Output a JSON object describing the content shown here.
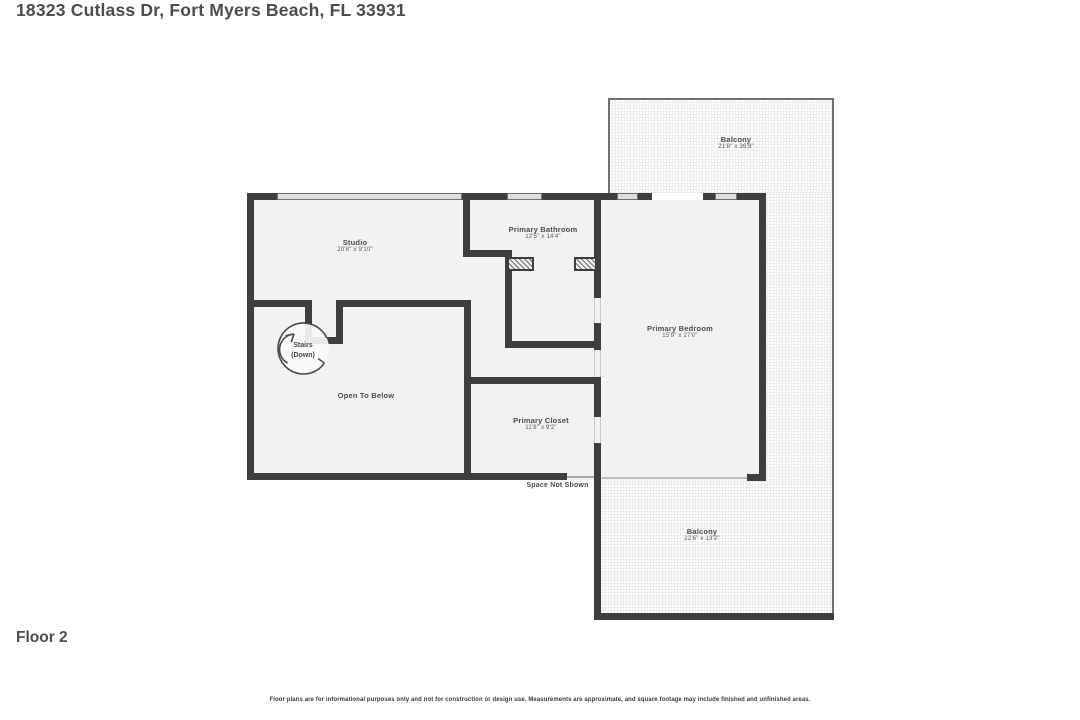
{
  "header": {
    "address": "18323 Cutlass Dr, Fort Myers Beach, FL 33931"
  },
  "footer": {
    "floor_label": "Floor 2",
    "disclaimer": "Floor plans are for informational purposes only and not for construction or design use. Measurements are approximate, and square footage may include finished and unfinished areas."
  },
  "rooms": {
    "balcony_top": {
      "name": "Balcony",
      "dims": "21'8\" x 36'8\""
    },
    "studio": {
      "name": "Studio",
      "dims": "20'8\" x 9'10\""
    },
    "primary_bathroom": {
      "name": "Primary Bathroom",
      "dims": "12'5\" x 14'4\""
    },
    "primary_bedroom": {
      "name": "Primary Bedroom",
      "dims": "15'9\" x 27'0\""
    },
    "open_to_below": {
      "name": "Open To Below"
    },
    "primary_closet": {
      "name": "Primary Closet",
      "dims": "11'8\" x 9'2\""
    },
    "balcony_bottom": {
      "name": "Balcony",
      "dims": "22'6\" x 13'2\""
    },
    "space_not_shown": {
      "name": "Space Not Shown"
    },
    "stairs": {
      "name": "Stairs",
      "direction": "(Down)"
    }
  },
  "colors": {
    "wall": "#3e3e3e",
    "room_fill": "#f2f2f2",
    "window_fill": "#dedede",
    "balcony_dot": "#e7e7e7",
    "text": "#4c4c4c",
    "background": "#ffffff"
  }
}
